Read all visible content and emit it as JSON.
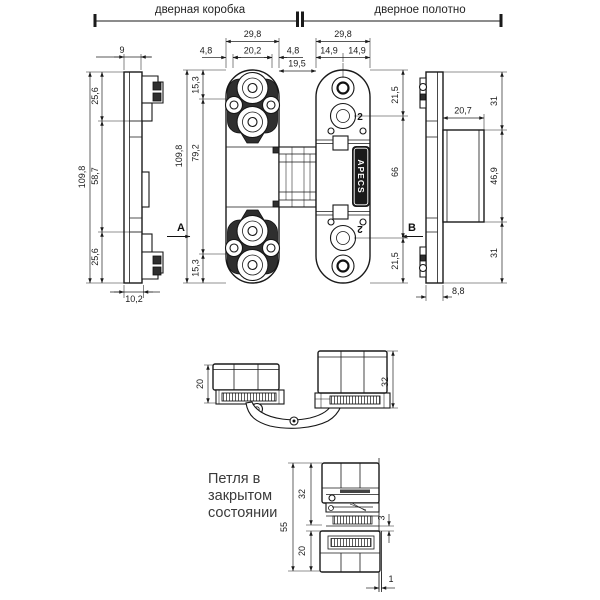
{
  "header": {
    "left": "дверная коробка",
    "right": "дверное полотно"
  },
  "brand_logo": "APECS",
  "sections": {
    "a": "A",
    "b": "B"
  },
  "hole_count_labels": {
    "top": "2",
    "bottom": "2"
  },
  "note": {
    "line1": "Петля в",
    "line2": "закрытом",
    "line3": "состоянии"
  },
  "dims": {
    "frame_side": {
      "top_width": "9",
      "overall": "109,8",
      "seg_top": "25,6",
      "seg_mid": "58,7",
      "seg_bottom": "25,6",
      "thickness": "10,2"
    },
    "frame_front": {
      "width": "29,8",
      "cup_width": "20,2",
      "offset_left": "4,8",
      "offset_right": "4,8",
      "gap": "19,5",
      "overall": "109,8",
      "body": "79,2",
      "end_top": "15,3",
      "end_bottom": "15,3"
    },
    "leaf_front": {
      "width": "29,8",
      "half_left": "14,9",
      "half_right": "14,9",
      "hole_top": "21,5",
      "hole_span": "66",
      "hole_bottom": "21,5"
    },
    "leaf_side": {
      "seg_top": "31",
      "cup_depth": "20,7",
      "cup_height": "46,9",
      "seg_bottom": "31",
      "thickness": "8,8"
    },
    "open_state": {
      "frame_stack": "20",
      "leaf_stack": "32"
    },
    "closed_state": {
      "overall": "55",
      "leaf_stack": "32",
      "frame_stack": "20",
      "gap": "3",
      "offset": "1"
    }
  }
}
